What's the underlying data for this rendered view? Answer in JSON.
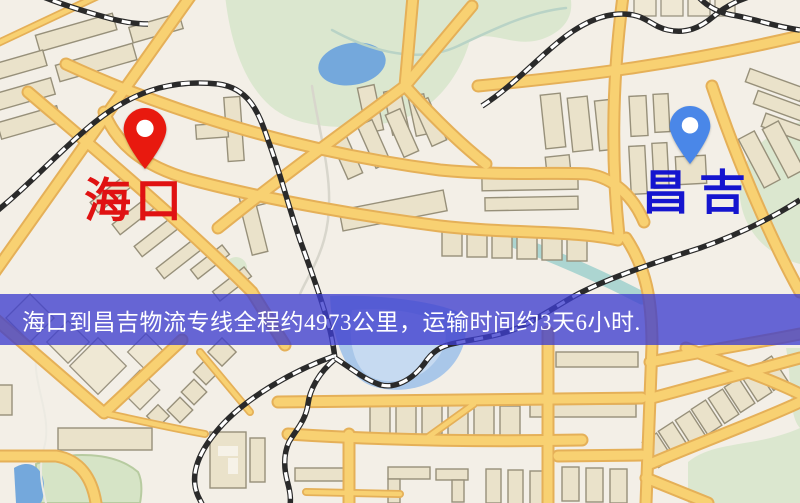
{
  "banner": {
    "text": "海口到昌吉物流专线全程约4973公里，运输时间约3天6小时."
  },
  "markers": {
    "origin": {
      "label": "海口",
      "pin_color": "#e8190f",
      "label_color": "#e01212"
    },
    "destination": {
      "label": "昌吉",
      "pin_color": "#4a87e8",
      "label_color": "#1515cf"
    }
  },
  "colors": {
    "banner_bg": "rgba(62,62,206,0.78)",
    "banner_text": "#ffffff",
    "land": "#f3efe7",
    "road_fill": "#f8d172",
    "road_casing": "#e5b058",
    "railway": "#2a2a2a",
    "water": "#74a8dc",
    "park": "#dbe7cf",
    "building": "#eae2ca"
  }
}
